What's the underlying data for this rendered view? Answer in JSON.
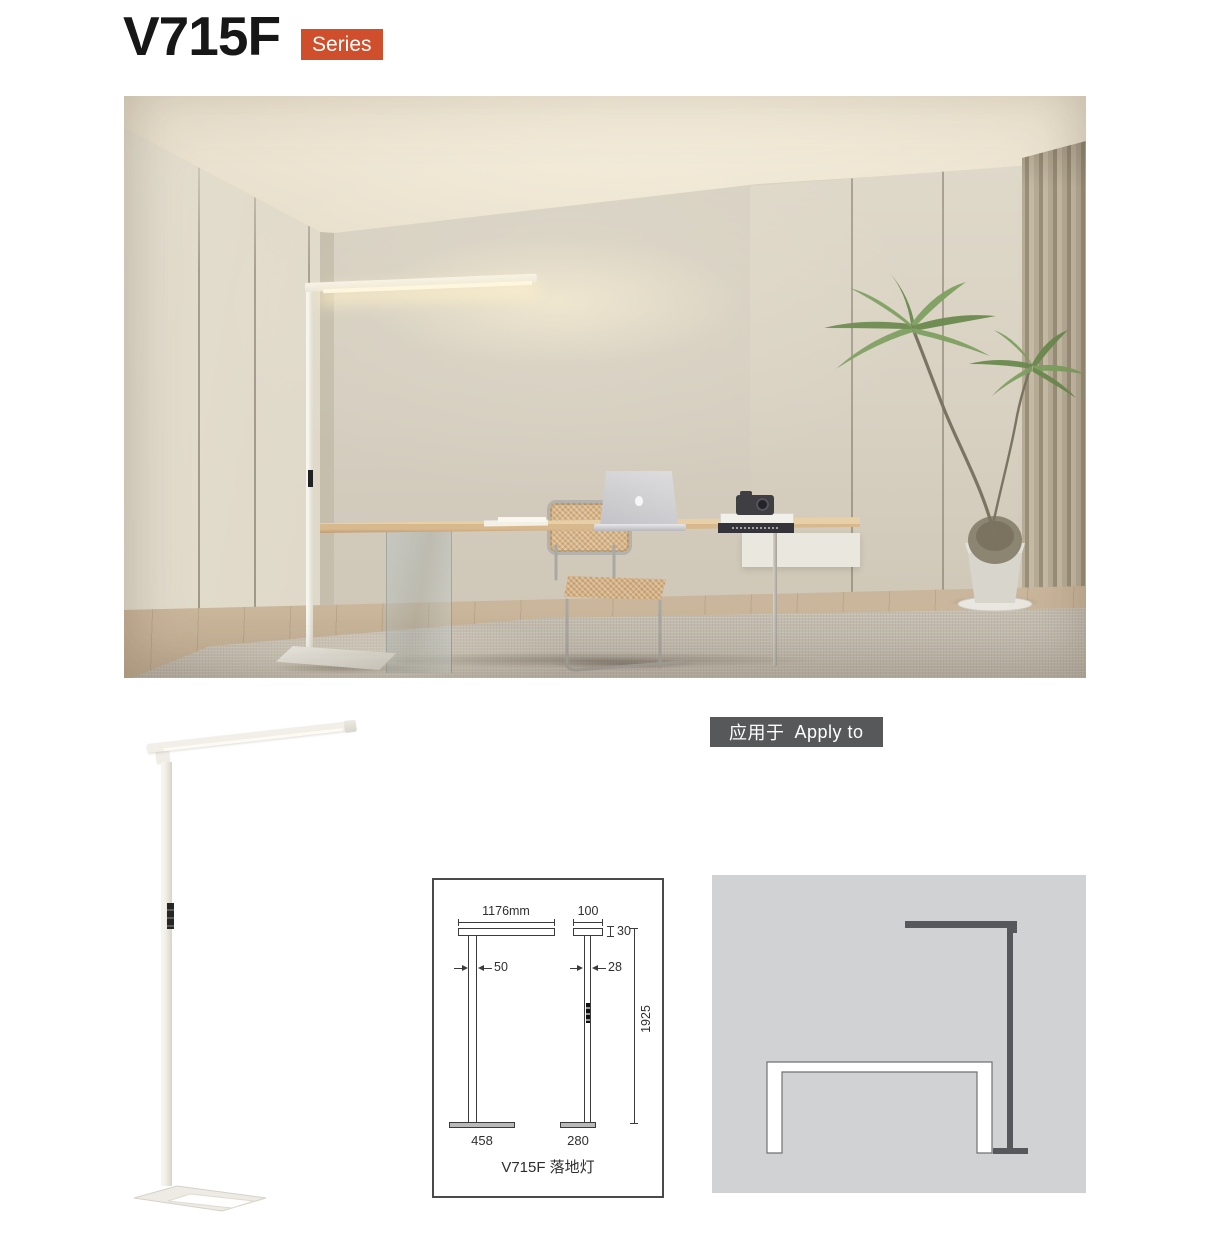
{
  "header": {
    "model": "V715F",
    "series": "Series"
  },
  "apply": {
    "zh": "应用于",
    "en": "Apply to"
  },
  "drawing": {
    "caption": "V715F 落地灯",
    "front": {
      "head_width": "1176mm",
      "pole_width": "50",
      "base_width": "458"
    },
    "side": {
      "head_width": "100",
      "head_height": "30",
      "pole_width": "28",
      "total_height": "1925",
      "base_width": "280"
    }
  },
  "colors": {
    "accent": "#cf4e2b",
    "apply_badge_bg": "#57585a",
    "diagram_bg": "#d1d2d4",
    "lamp_silhouette": "#57585b"
  }
}
